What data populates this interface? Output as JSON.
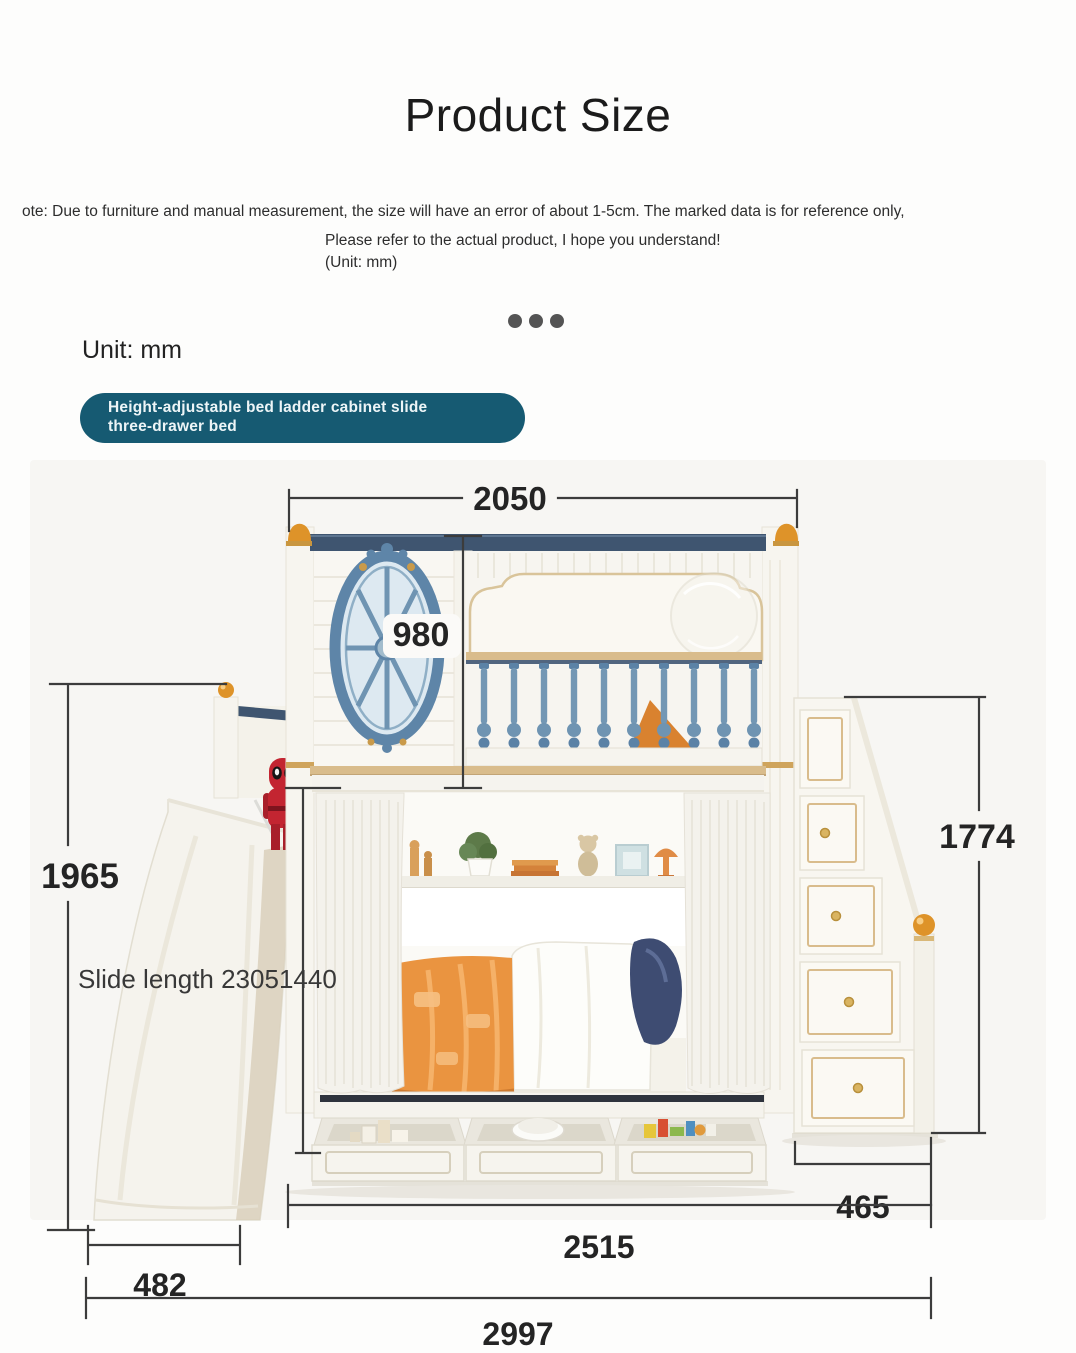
{
  "header": {
    "title": "Product Size",
    "note": "ote: Due to furniture and manual measurement, the size will have an error of about 1-5cm. The marked data is for reference only,",
    "note2": "Please refer to the actual product, I hope you understand!",
    "unit_note": "(Unit: mm)",
    "unit_label": "Unit: mm",
    "badge_line1": "Height-adjustable bed ladder cabinet slide",
    "badge_line2": "three-drawer bed"
  },
  "dimensions": {
    "top_width": "2050",
    "upper_bunk_height": "980",
    "overall_height": "1965",
    "ladder_height": "1774",
    "slide_length_note": "Slide length 23051440",
    "ladder_depth": "465",
    "bed_length": "2515",
    "slide_width": "482",
    "overall_length": "2997"
  },
  "colors": {
    "badge_bg": "#165a72",
    "rail_navy": "#3f5570",
    "finial_orange": "#de9329",
    "window_blue": "#5e85a8",
    "baluster_blue": "#6f94b2",
    "blanket_orange": "#ea9440",
    "pillow_navy": "#3e4c72",
    "gold_trim": "#d9bc8c",
    "dimension_line": "#3c3c3c"
  }
}
